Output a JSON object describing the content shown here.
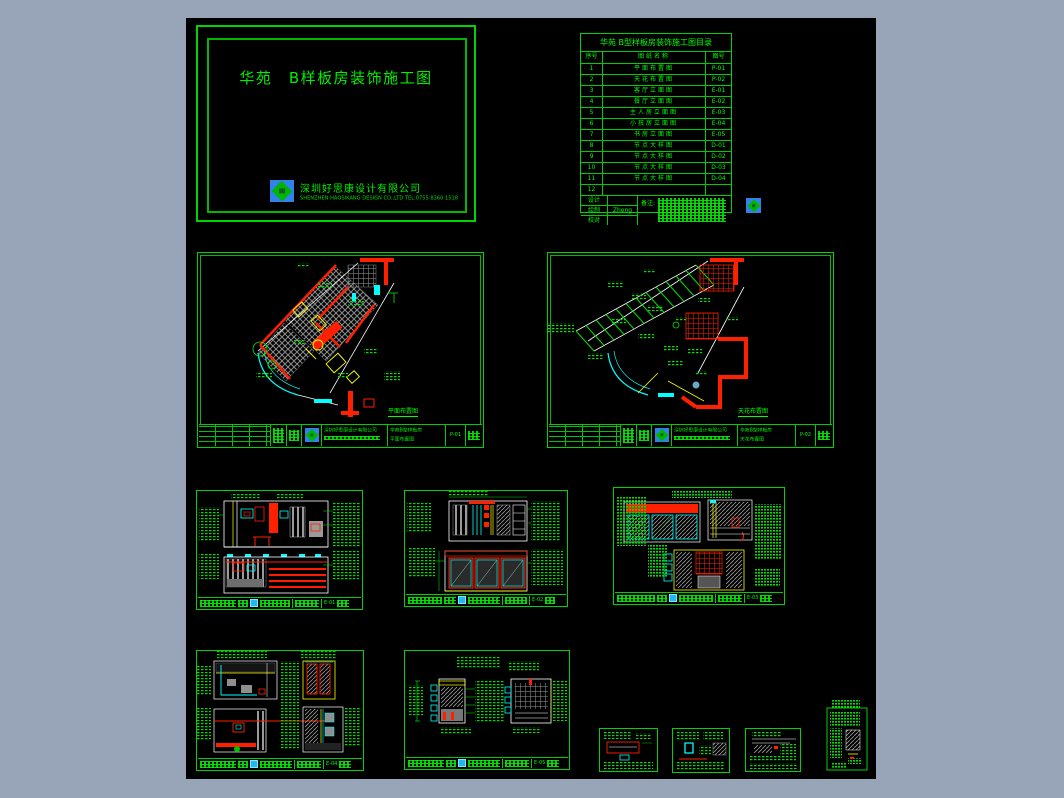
{
  "frame": {
    "bg": "#98a5b8",
    "canvas_bg": "#000000"
  },
  "colors": {
    "line_green": "#00d400",
    "text_green": "#00ff00",
    "red": "#ff1e00",
    "cyan": "#00ffff",
    "yellow": "#ffff00",
    "white": "#ffffff",
    "gray": "#8f8f8f",
    "logo_blue": "#2f82e8"
  },
  "cover": {
    "project_title": "华苑　B样板房装饰施工图",
    "company_name": "深圳好思康设计有限公司",
    "company_info": "SHENZHEN HAOSIKANG DESIGN CO.,LTD  TEL:0755 8360 1518",
    "logo_icon": "company-logo"
  },
  "directory": {
    "title": "华苑 B型样板房装饰施工图目录",
    "headers": {
      "no": "序号",
      "name": "图纸名称",
      "number": "图号"
    },
    "rows": [
      {
        "no": "1",
        "name": "平面布置图",
        "number": "P-01"
      },
      {
        "no": "2",
        "name": "天花布置图",
        "number": "P-02"
      },
      {
        "no": "3",
        "name": "客厅立面图",
        "number": "E-01"
      },
      {
        "no": "4",
        "name": "餐厅立面图",
        "number": "E-02"
      },
      {
        "no": "5",
        "name": "主人房立面图",
        "number": "E-03"
      },
      {
        "no": "6",
        "name": "小孩房立面图",
        "number": "E-04"
      },
      {
        "no": "7",
        "name": "书房立面图",
        "number": "E-05"
      },
      {
        "no": "8",
        "name": "节点大样图",
        "number": "D-01"
      },
      {
        "no": "9",
        "name": "节点大样图",
        "number": "D-02"
      },
      {
        "no": "10",
        "name": "节点大样图",
        "number": "D-03"
      },
      {
        "no": "11",
        "name": "节点大样图",
        "number": "D-04"
      },
      {
        "no": "12",
        "name": "",
        "number": ""
      }
    ],
    "footer": {
      "design": "设计",
      "draft": "绘制",
      "check": "校对",
      "drafter_sig": "Zheng",
      "remark": "备注:"
    }
  },
  "sheets": {
    "plan1": {
      "caption": "平面布置图",
      "number": "P-01",
      "project": "华苑B型样板房",
      "company": "深圳好思康设计有限公司"
    },
    "plan2": {
      "caption": "天花布置图",
      "number": "P-02",
      "project": "华苑B型样板房",
      "company": "深圳好思康设计有限公司"
    },
    "elev1": {
      "number": "E-01"
    },
    "elev2": {
      "number": "E-02"
    },
    "elev3": {
      "number": "E-03"
    },
    "elev4": {
      "number": "E-04"
    },
    "elev5": {
      "number": "E-05"
    },
    "det1": {
      "number": "D-01"
    },
    "det2": {
      "number": "D-02"
    },
    "det3": {
      "number": "D-03"
    },
    "det4": {
      "number": "D-04"
    }
  }
}
